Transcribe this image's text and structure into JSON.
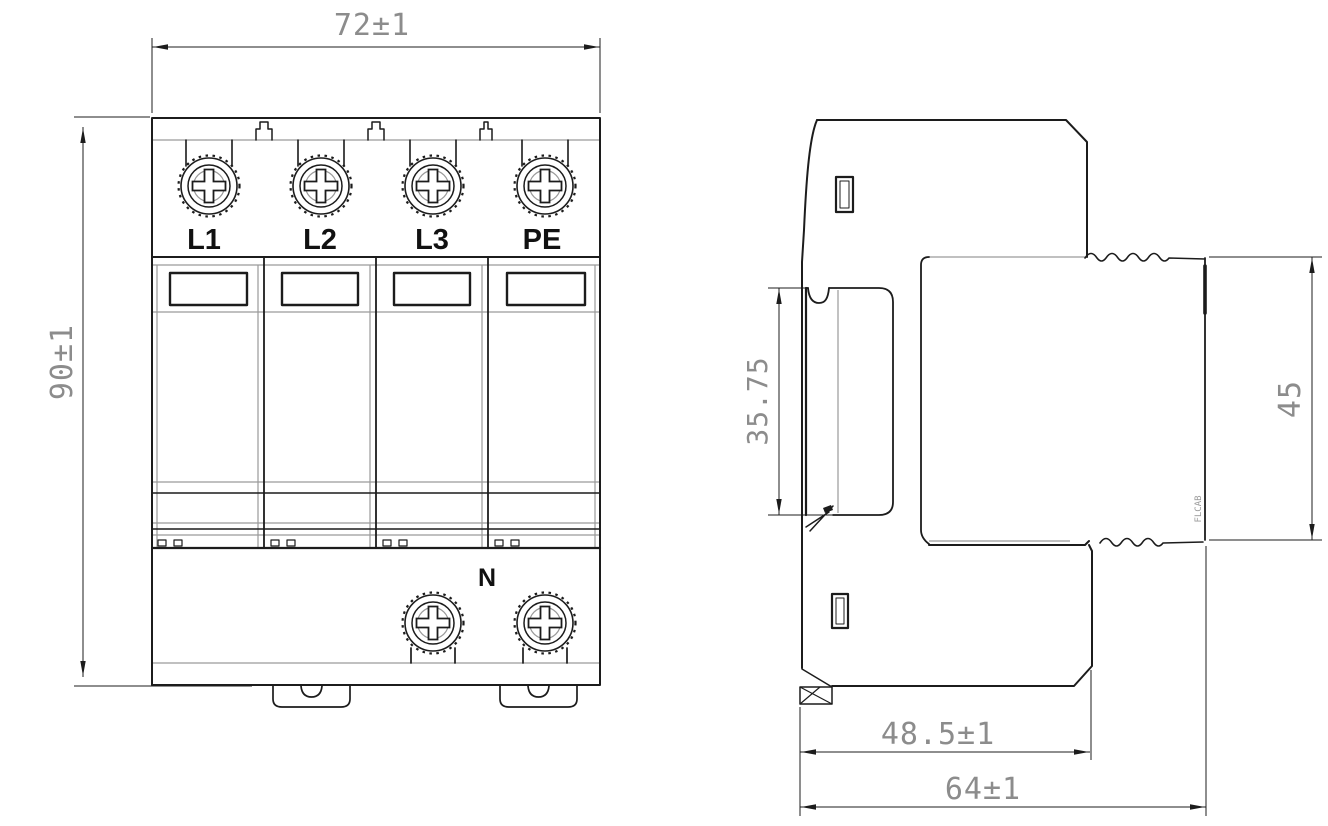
{
  "drawing": {
    "type": "technical-dimension-drawing",
    "subject": "DIN-rail surge protective device, front and side views",
    "front_view": {
      "terminals": [
        {
          "label": "L1"
        },
        {
          "label": "L2"
        },
        {
          "label": "L3"
        },
        {
          "label": "PE"
        }
      ],
      "neutral_terminal_label": "N",
      "dimensions": {
        "overall_width": "72±1",
        "overall_height": "90±1"
      }
    },
    "side_view": {
      "dimensions": {
        "rail_recess_height": "35.75",
        "module_height": "45",
        "base_depth": "48.5±1",
        "overall_depth": "64±1"
      },
      "marking": "FLCAB"
    },
    "style": {
      "line_color": "#1c1c1c",
      "thin_line_color": "#9a9a9a",
      "dim_text_color": "#8c8c8c",
      "background": "#ffffff"
    }
  }
}
